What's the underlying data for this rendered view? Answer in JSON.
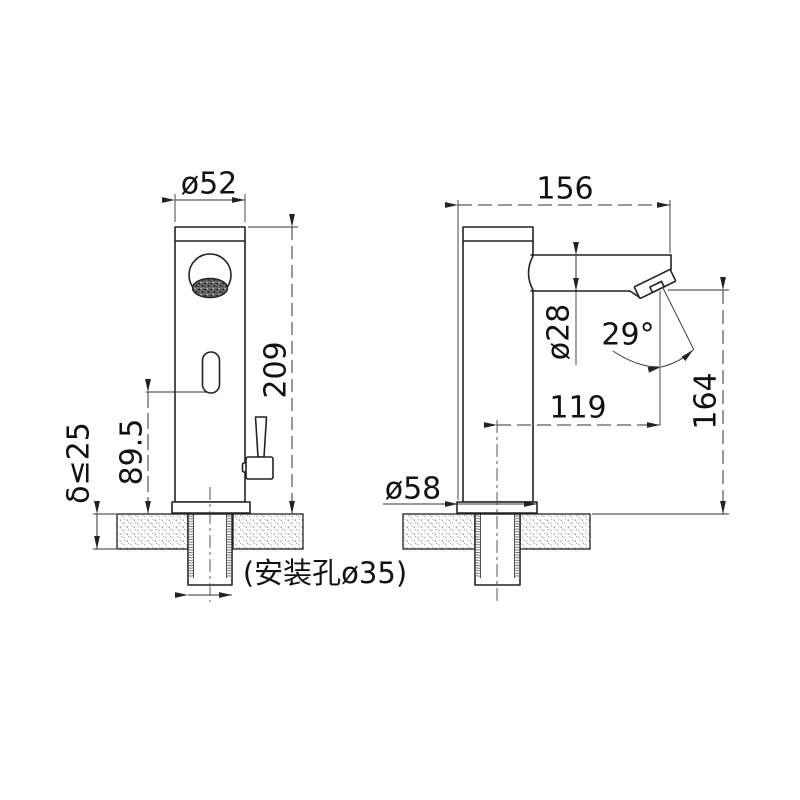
{
  "page": {
    "background": "#ffffff",
    "line_color": "#222222",
    "type_label": "faucet-dimension-drawing"
  },
  "views": {
    "front": {
      "dims": {
        "top_diameter": "ø52",
        "total_height": "209",
        "sensor_height": "89.5",
        "deck_thickness": "δ≤25",
        "mounting_note": "(安装孔ø35)"
      }
    },
    "side": {
      "dims": {
        "total_depth": "156",
        "spout_diameter": "ø28",
        "outlet_angle": "29°",
        "outlet_reach": "119",
        "outlet_height": "164",
        "base_diameter": "ø58"
      }
    }
  }
}
